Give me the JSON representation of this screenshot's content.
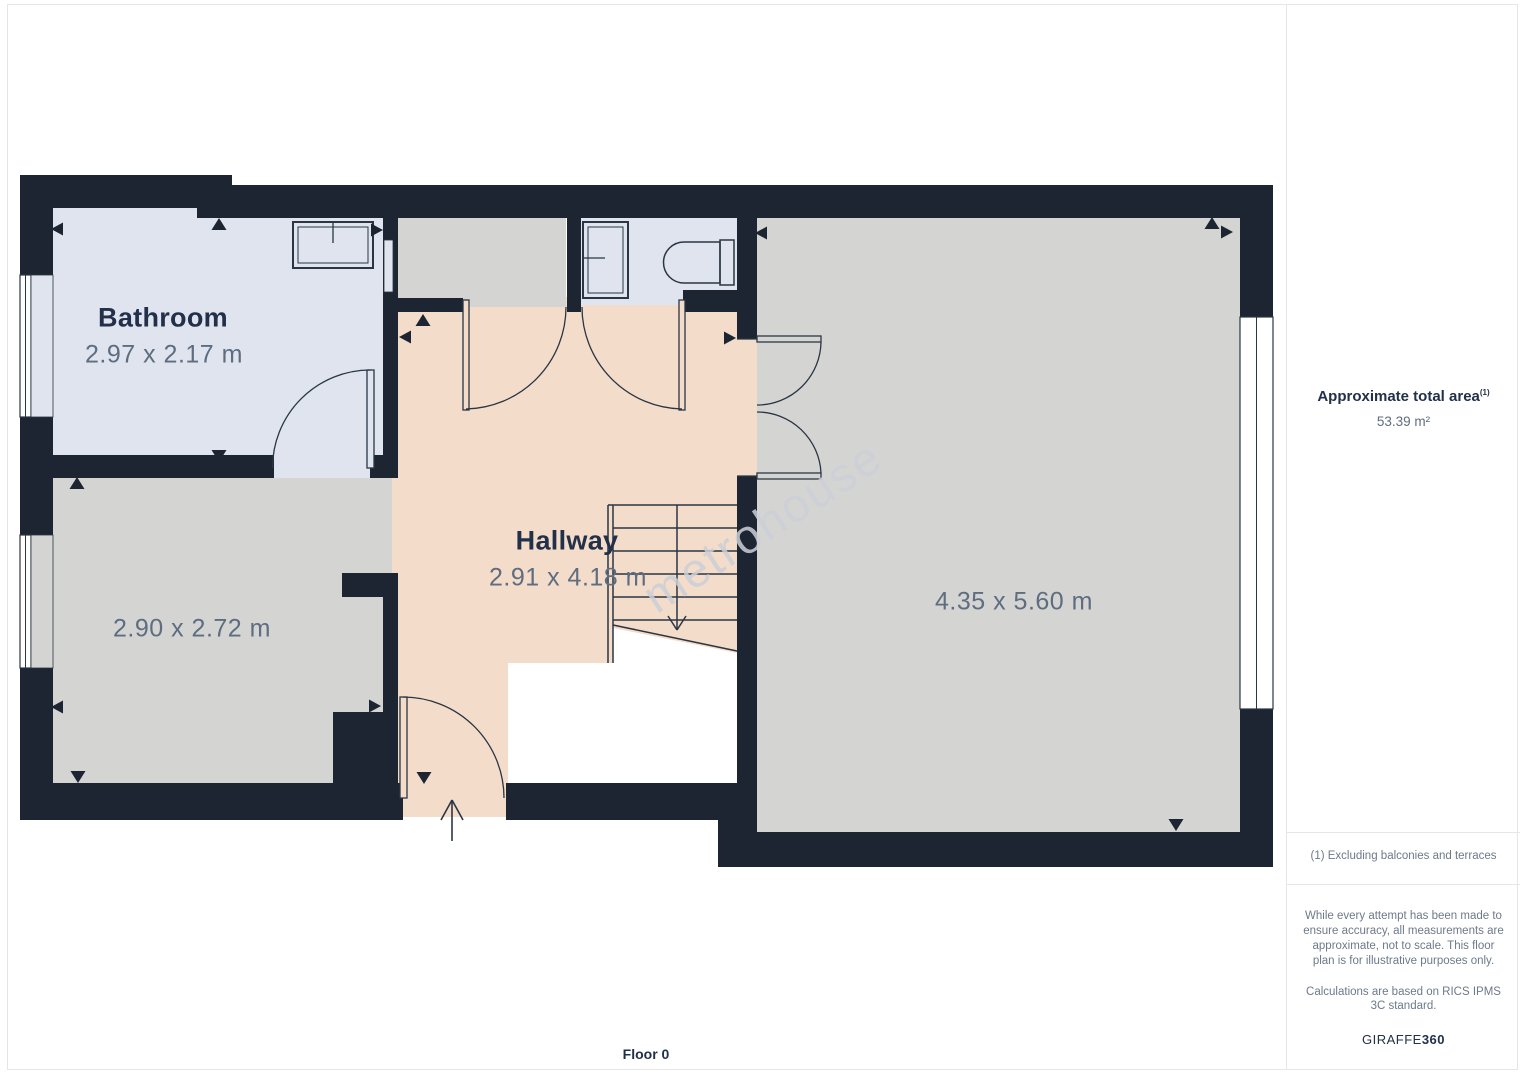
{
  "floor": {
    "label": "Floor 0"
  },
  "watermark": "metrohouse",
  "rooms": {
    "bathroom": {
      "name": "Bathroom",
      "dims": "2.97 x 2.17 m"
    },
    "hallway": {
      "name": "Hallway",
      "dims": "2.91 x 4.18 m"
    },
    "room_small": {
      "dims": "2.90 x 2.72 m"
    },
    "room_large": {
      "dims": "4.35 x 5.60 m"
    }
  },
  "sidebar": {
    "area_title": "Approximate total area",
    "area_footnote_ref": "(1)",
    "area_value": "53.39 m²",
    "footnote": "(1) Excluding balconies and terraces",
    "disclaimer": "While every attempt has been made to ensure accuracy, all measurements are approximate, not to scale. This floor plan is for illustrative purposes only.",
    "standard_note": "Calculations are based on RICS IPMS 3C standard.",
    "brand": "GIRAFFE",
    "brand_suffix": "360"
  },
  "colors": {
    "wall": "#1d2532",
    "bathroom_floor": "#dfe4ef",
    "hallway_floor": "#f3dcc9",
    "room_floor": "#d4d4d2",
    "stroke": "#2a3644",
    "ink": "#22304a",
    "dim_text": "#5e6d80",
    "muted_text": "#6d7a8a",
    "divider": "#e6e6e6",
    "watermark": "#ccd0d8"
  }
}
